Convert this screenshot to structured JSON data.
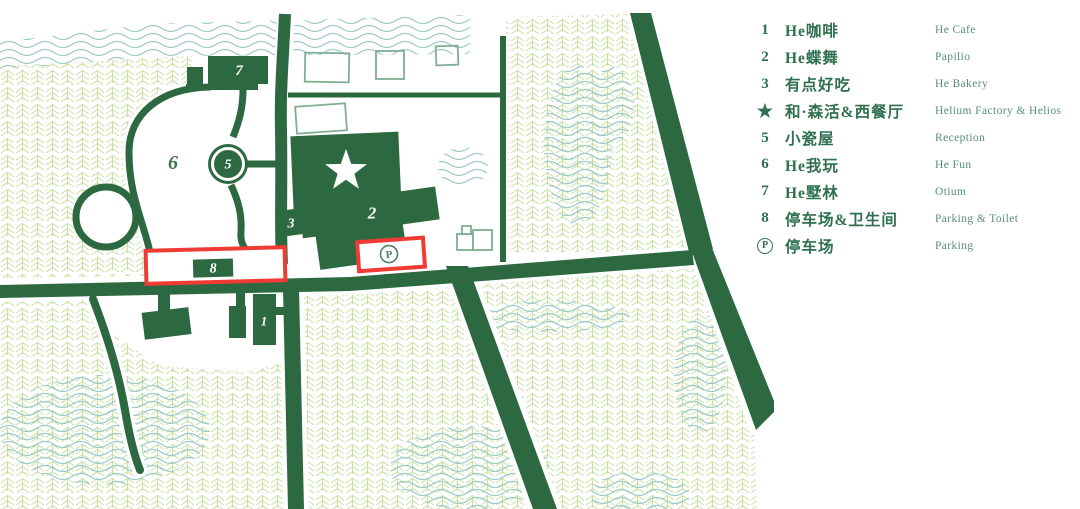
{
  "title": "Resort site map with legend",
  "colors": {
    "primary_green": "#2d6940",
    "legend_text_zh": "#2e6f4e",
    "legend_text_en": "#579070",
    "highlight_red": "#ef3b33",
    "tree_hatch": "#c9e0a4",
    "water_wave": "#9ccac8",
    "sketch_outline": "#7fae92"
  },
  "map": {
    "markers": {
      "n7": "7",
      "n6": "6",
      "n5": "5",
      "n2": "2",
      "n3": "3",
      "n8": "8",
      "n1": "1",
      "p": "P"
    }
  },
  "legend": {
    "items": [
      {
        "marker": "1",
        "style": "number",
        "zh": "He咖啡",
        "en": "He Cafe"
      },
      {
        "marker": "2",
        "style": "number",
        "zh": "He蝶舞",
        "en": "Papilio"
      },
      {
        "marker": "3",
        "style": "number",
        "zh": "有点好吃",
        "en": "He Bakery"
      },
      {
        "marker": "★",
        "style": "star",
        "zh": "和·森活&西餐厅",
        "en": "Helium Factory & Helios"
      },
      {
        "marker": "5",
        "style": "number",
        "zh": "小瓷屋",
        "en": "Reception"
      },
      {
        "marker": "6",
        "style": "number",
        "zh": "He我玩",
        "en": "He Fun"
      },
      {
        "marker": "7",
        "style": "number",
        "zh": "He墅林",
        "en": "Otium"
      },
      {
        "marker": "8",
        "style": "number",
        "zh": "停车场&卫生间",
        "en": "Parking & Toilet"
      },
      {
        "marker": "P",
        "style": "circled",
        "zh": "停车场",
        "en": "Parking"
      }
    ]
  }
}
